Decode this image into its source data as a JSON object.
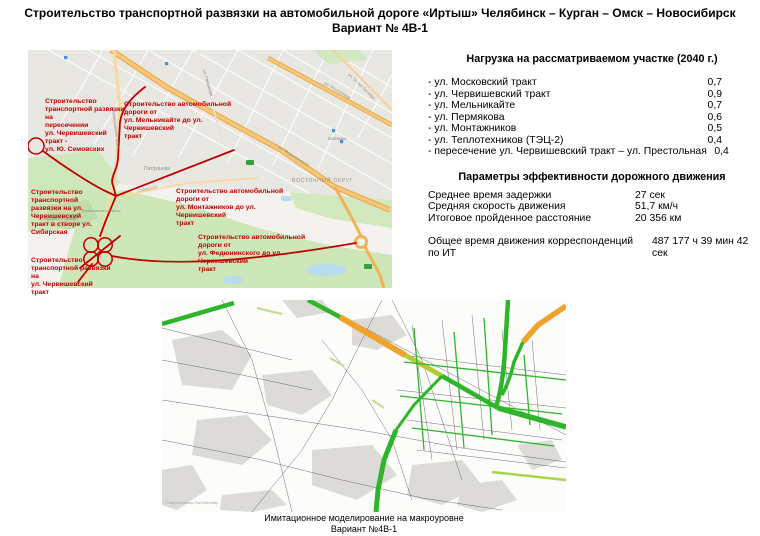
{
  "title": {
    "line1": "Строительство транспортной развязки на автомобильной дороге «Иртыш» Челябинск – Курган – Омск – Новосибирск",
    "line2": "Вариант № 4В-1"
  },
  "load_section": {
    "heading": "Нагрузка на рассматриваемом участке (2040 г.)",
    "rows": [
      {
        "label": "- ул. Московский тракт",
        "value": "0,7"
      },
      {
        "label": "- ул. Червишевский тракт",
        "value": "0,9"
      },
      {
        "label": "- ул. Мельникайте",
        "value": "0,7"
      },
      {
        "label": "- ул. Пермякова",
        "value": "0,6"
      },
      {
        "label": "- ул. Монтажников",
        "value": "0,5"
      },
      {
        "label": "- ул. Теплотехников (ТЭЦ-2)",
        "value": "0,4"
      },
      {
        "label": "- пересечение ул. Червишевский тракт – ул. Престольная",
        "value": "0,4"
      }
    ]
  },
  "efficiency_section": {
    "heading": "Параметры эффективности дорожного движения",
    "rows": [
      {
        "label": "Среднее время задержки",
        "value": "27 сек"
      },
      {
        "label": "Средняя скорость движения",
        "value": "51,7 км/ч"
      },
      {
        "label": "Итоговое пройденное расстояние",
        "value": "20 356 км"
      }
    ],
    "total_label": "Общее время движения корреспонденций по ИТ",
    "total_value": "487 177 ч 39 мин 42 сек"
  },
  "plan_map": {
    "annotations": [
      "Строительство\nтранспортной развязки на\nпересечении\nул. Червишевский тракт -\nул. Ю. Семовских",
      "Строительство автомобильной дороги от\nул. Мельникайте до ул. Червишевский\nтракт",
      "Строительство транспортной\nразвязки на ул. Червишевский\nтракт в створе ул. Сибирская",
      "Строительство автомобильной дороги от\nул. Монтажников до ул. Червишевский\nтракт",
      "Строительство автомобильной дороги от\nул. Федюнинского до ул. Червишевский\nтракт",
      "Строительство\nтранспортной развязки на\nул. Червишевский тракт"
    ],
    "labels": {
      "district": "ВОСТОЧНЫЙ ОКРУГ",
      "village": "Патрушева",
      "station": "Войновка",
      "street_chervishevsky": "Червишевский тракт",
      "street_fedyuninskogo": "ул. Федюнинского",
      "street_respubliki": "ул. Республики",
      "street_50let": "ул. 50 лет Октября",
      "street_permyakova": "ул. Пермякова",
      "street_sibirskaya": "Сибирская",
      "cemetery": "Червишевское кладбище"
    }
  },
  "sim_map": {
    "attribution": "© Картматериалы OpenStreetMap",
    "caption_line1": "Имитационное моделирование на макроуровне",
    "caption_line2": "Вариант №4В-1"
  },
  "colors": {
    "annotation_red": "#c00000",
    "route_red": "#c00000",
    "traffic_green": "#2eb52a",
    "traffic_orange": "#efa32b",
    "traffic_yellowgreen": "#b5cc33"
  }
}
